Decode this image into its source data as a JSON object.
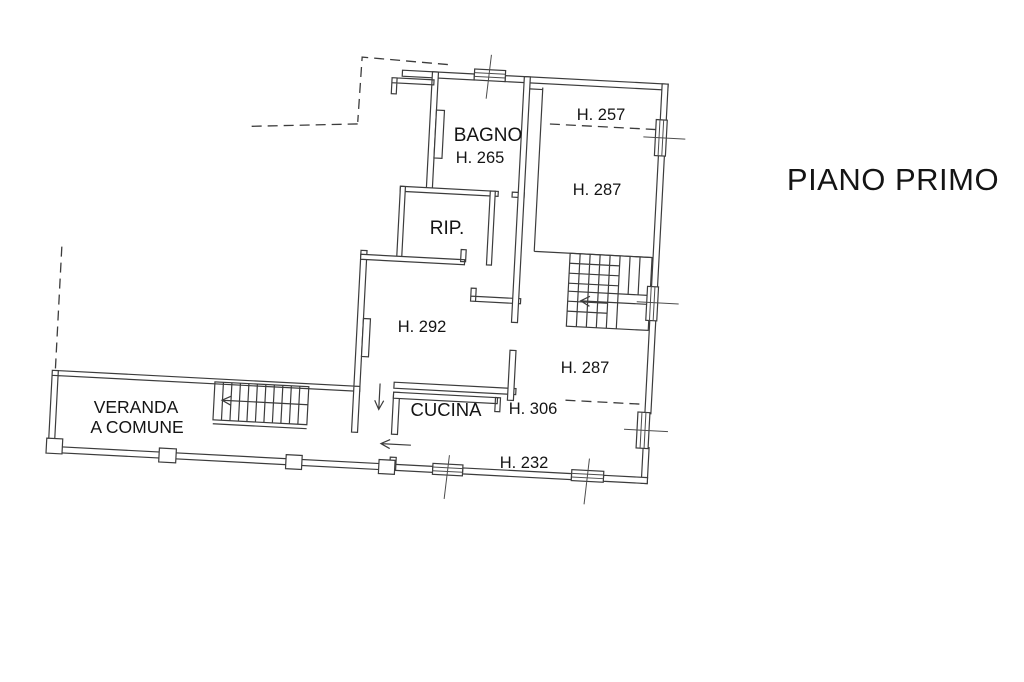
{
  "title": "PIANO PRIMO",
  "plan": {
    "rooms": {
      "bagno": {
        "name": "BAGNO",
        "height": "H. 265"
      },
      "room_257": {
        "height": "H. 257"
      },
      "room_287_upper": {
        "height": "H. 287"
      },
      "rip": {
        "name": "RIP."
      },
      "room_292": {
        "height": "H. 292"
      },
      "room_287_lower": {
        "height": "H. 287"
      },
      "veranda": {
        "name_line1": "VERANDA",
        "name_line2": "A COMUNE"
      },
      "cucina": {
        "name": "CUCINA",
        "height": "H. 306"
      },
      "strip_232": {
        "height": "H. 232"
      }
    }
  }
}
